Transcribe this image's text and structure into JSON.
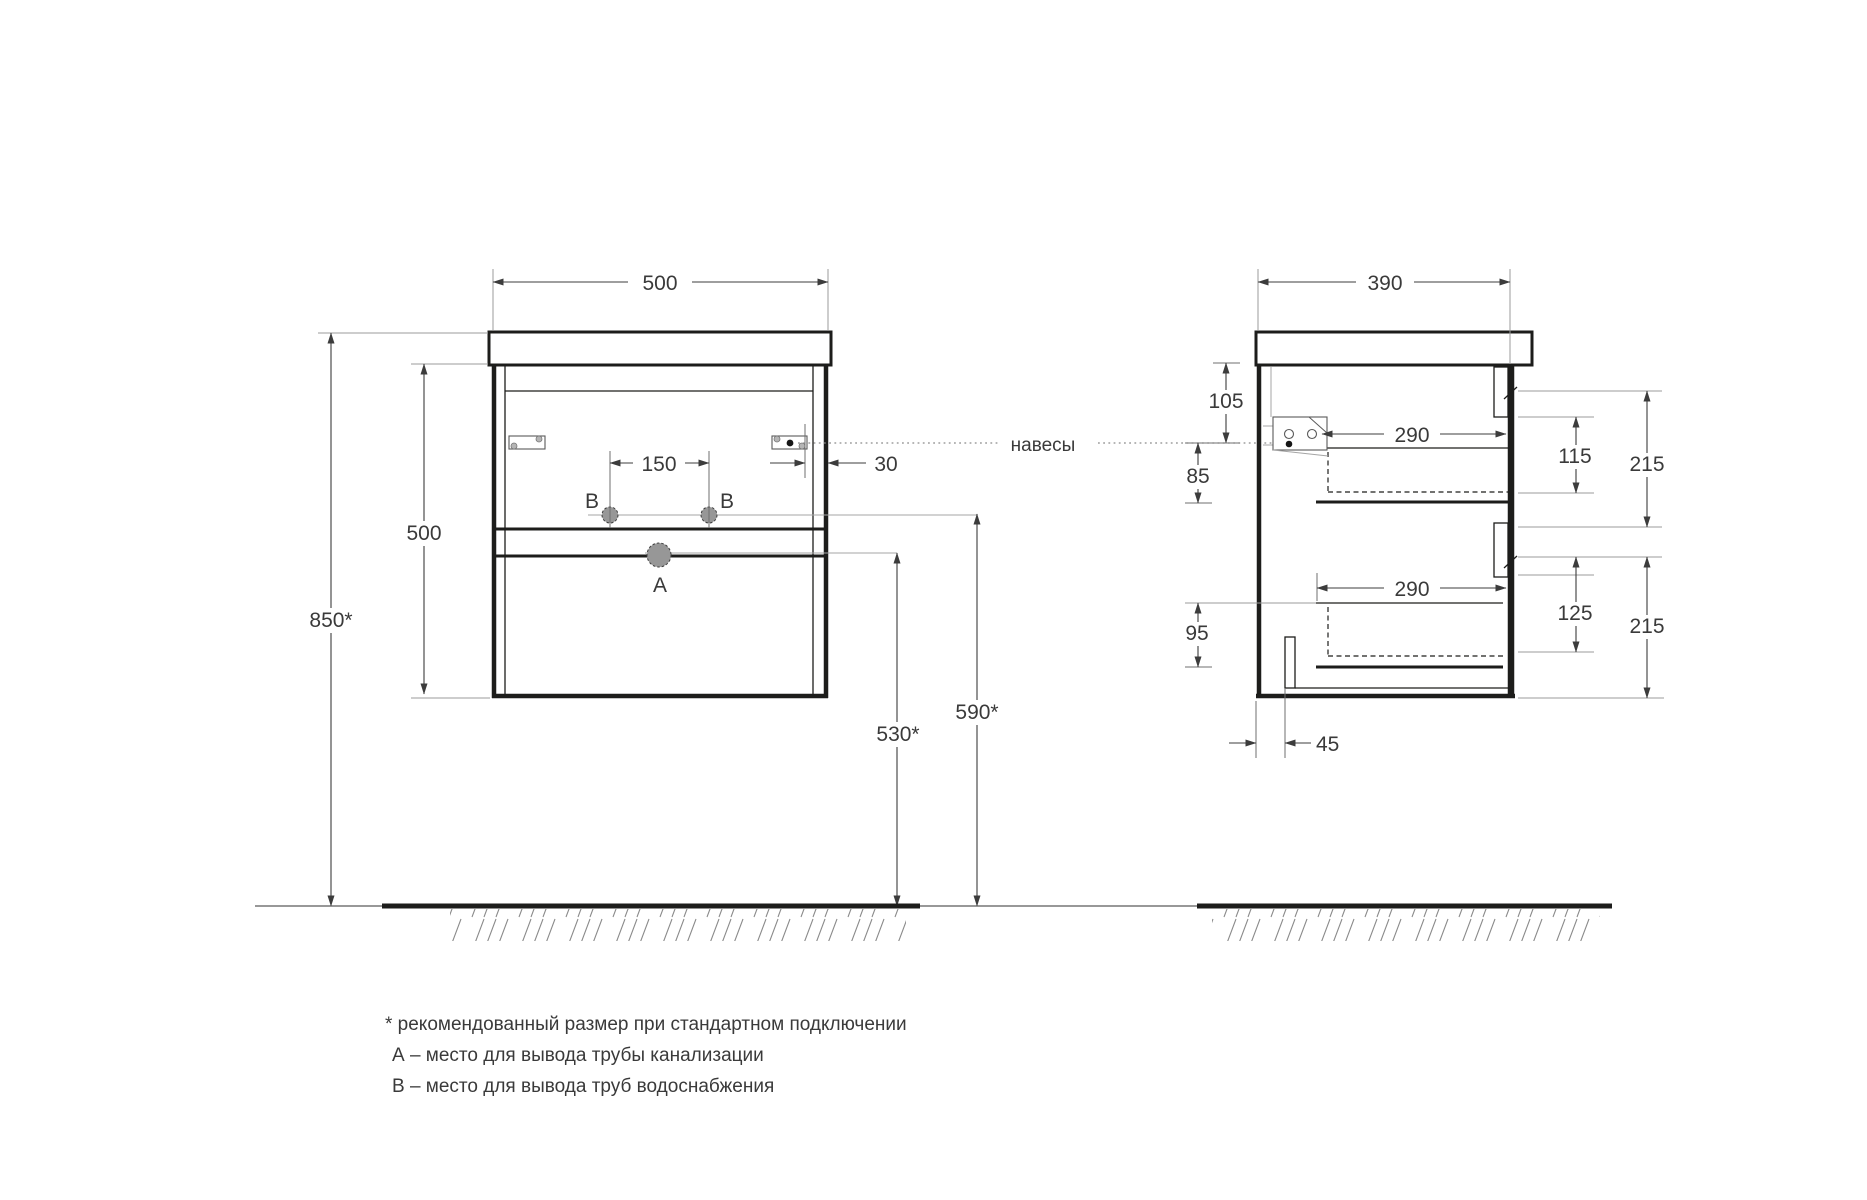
{
  "front_view": {
    "labels": {
      "a": "A",
      "b_left": "B",
      "b_right": "B"
    },
    "dims": {
      "width": "500",
      "cabinet_height": "500",
      "mount_height": "850*",
      "supply_spacing": "150",
      "wall_offset": "30",
      "drain_outlet_height": "530*",
      "supply_outlet_height": "590*"
    }
  },
  "side_view": {
    "dims": {
      "depth": "390",
      "top_inset": "105",
      "hanger_inset": "85",
      "drawer_top_depth": "290",
      "drawer_top_inner_height": "115",
      "drawer_top_front_height": "215",
      "drawer_bottom_depth": "290",
      "drawer_bottom_inner_height": "125",
      "drawer_bottom_front_height": "215",
      "bottom_inset": "95",
      "back_offset": "45"
    }
  },
  "callout": {
    "hangers": "навесы"
  },
  "legend": {
    "note": "* рекомендованный размер при стандартном подключении",
    "item_a": "А – место для вывода трубы канализации",
    "item_b": "В – место для вывода труб водоснабжения"
  },
  "colors": {
    "line": "#1d1d1b",
    "dim": "#3c3c3c",
    "extension": "#9b9b9b",
    "hole_fill": "#979797",
    "text": "#3a3a3a"
  }
}
